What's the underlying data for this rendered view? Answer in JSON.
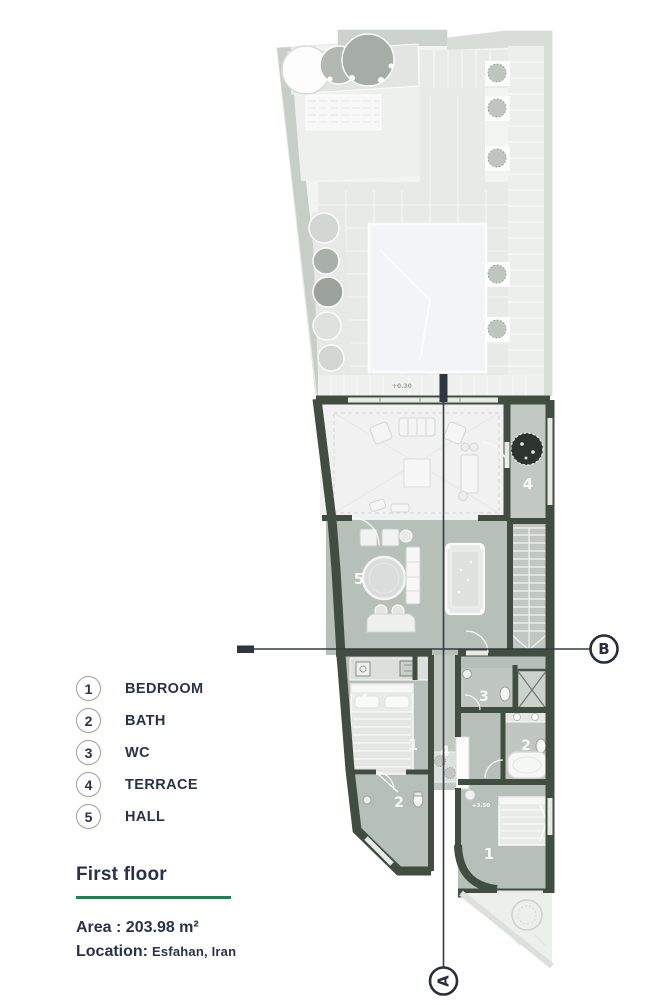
{
  "legend": {
    "items": [
      {
        "number": "1",
        "label": "BEDROOM"
      },
      {
        "number": "2",
        "label": "BATH"
      },
      {
        "number": "3",
        "label": "WC"
      },
      {
        "number": "4",
        "label": "TERRACE"
      },
      {
        "number": "5",
        "label": "HALL"
      }
    ]
  },
  "info": {
    "title": "First floor",
    "area": "Area : 203.98 m²",
    "location_label": "Location:",
    "location_value": "Esfahan, Iran"
  },
  "plan": {
    "section_a": "A",
    "section_b": "B",
    "rooms": {
      "terrace_upper": "4",
      "hall": "5",
      "terrace_balcony": "4",
      "bedroom_left": "1",
      "bath_left": "2",
      "terrace_mid": "4",
      "wc": "3",
      "bath_right": "2",
      "bedroom_right": "1"
    },
    "levels": {
      "garden": "+0.30",
      "bedroom": "+3.50"
    },
    "colors": {
      "wall": "#414d40",
      "accent_green": "#1e7f4f",
      "floor_sage": "#b6bfb8",
      "floor_light": "#f0f1f0",
      "ink": "#28324a"
    }
  }
}
